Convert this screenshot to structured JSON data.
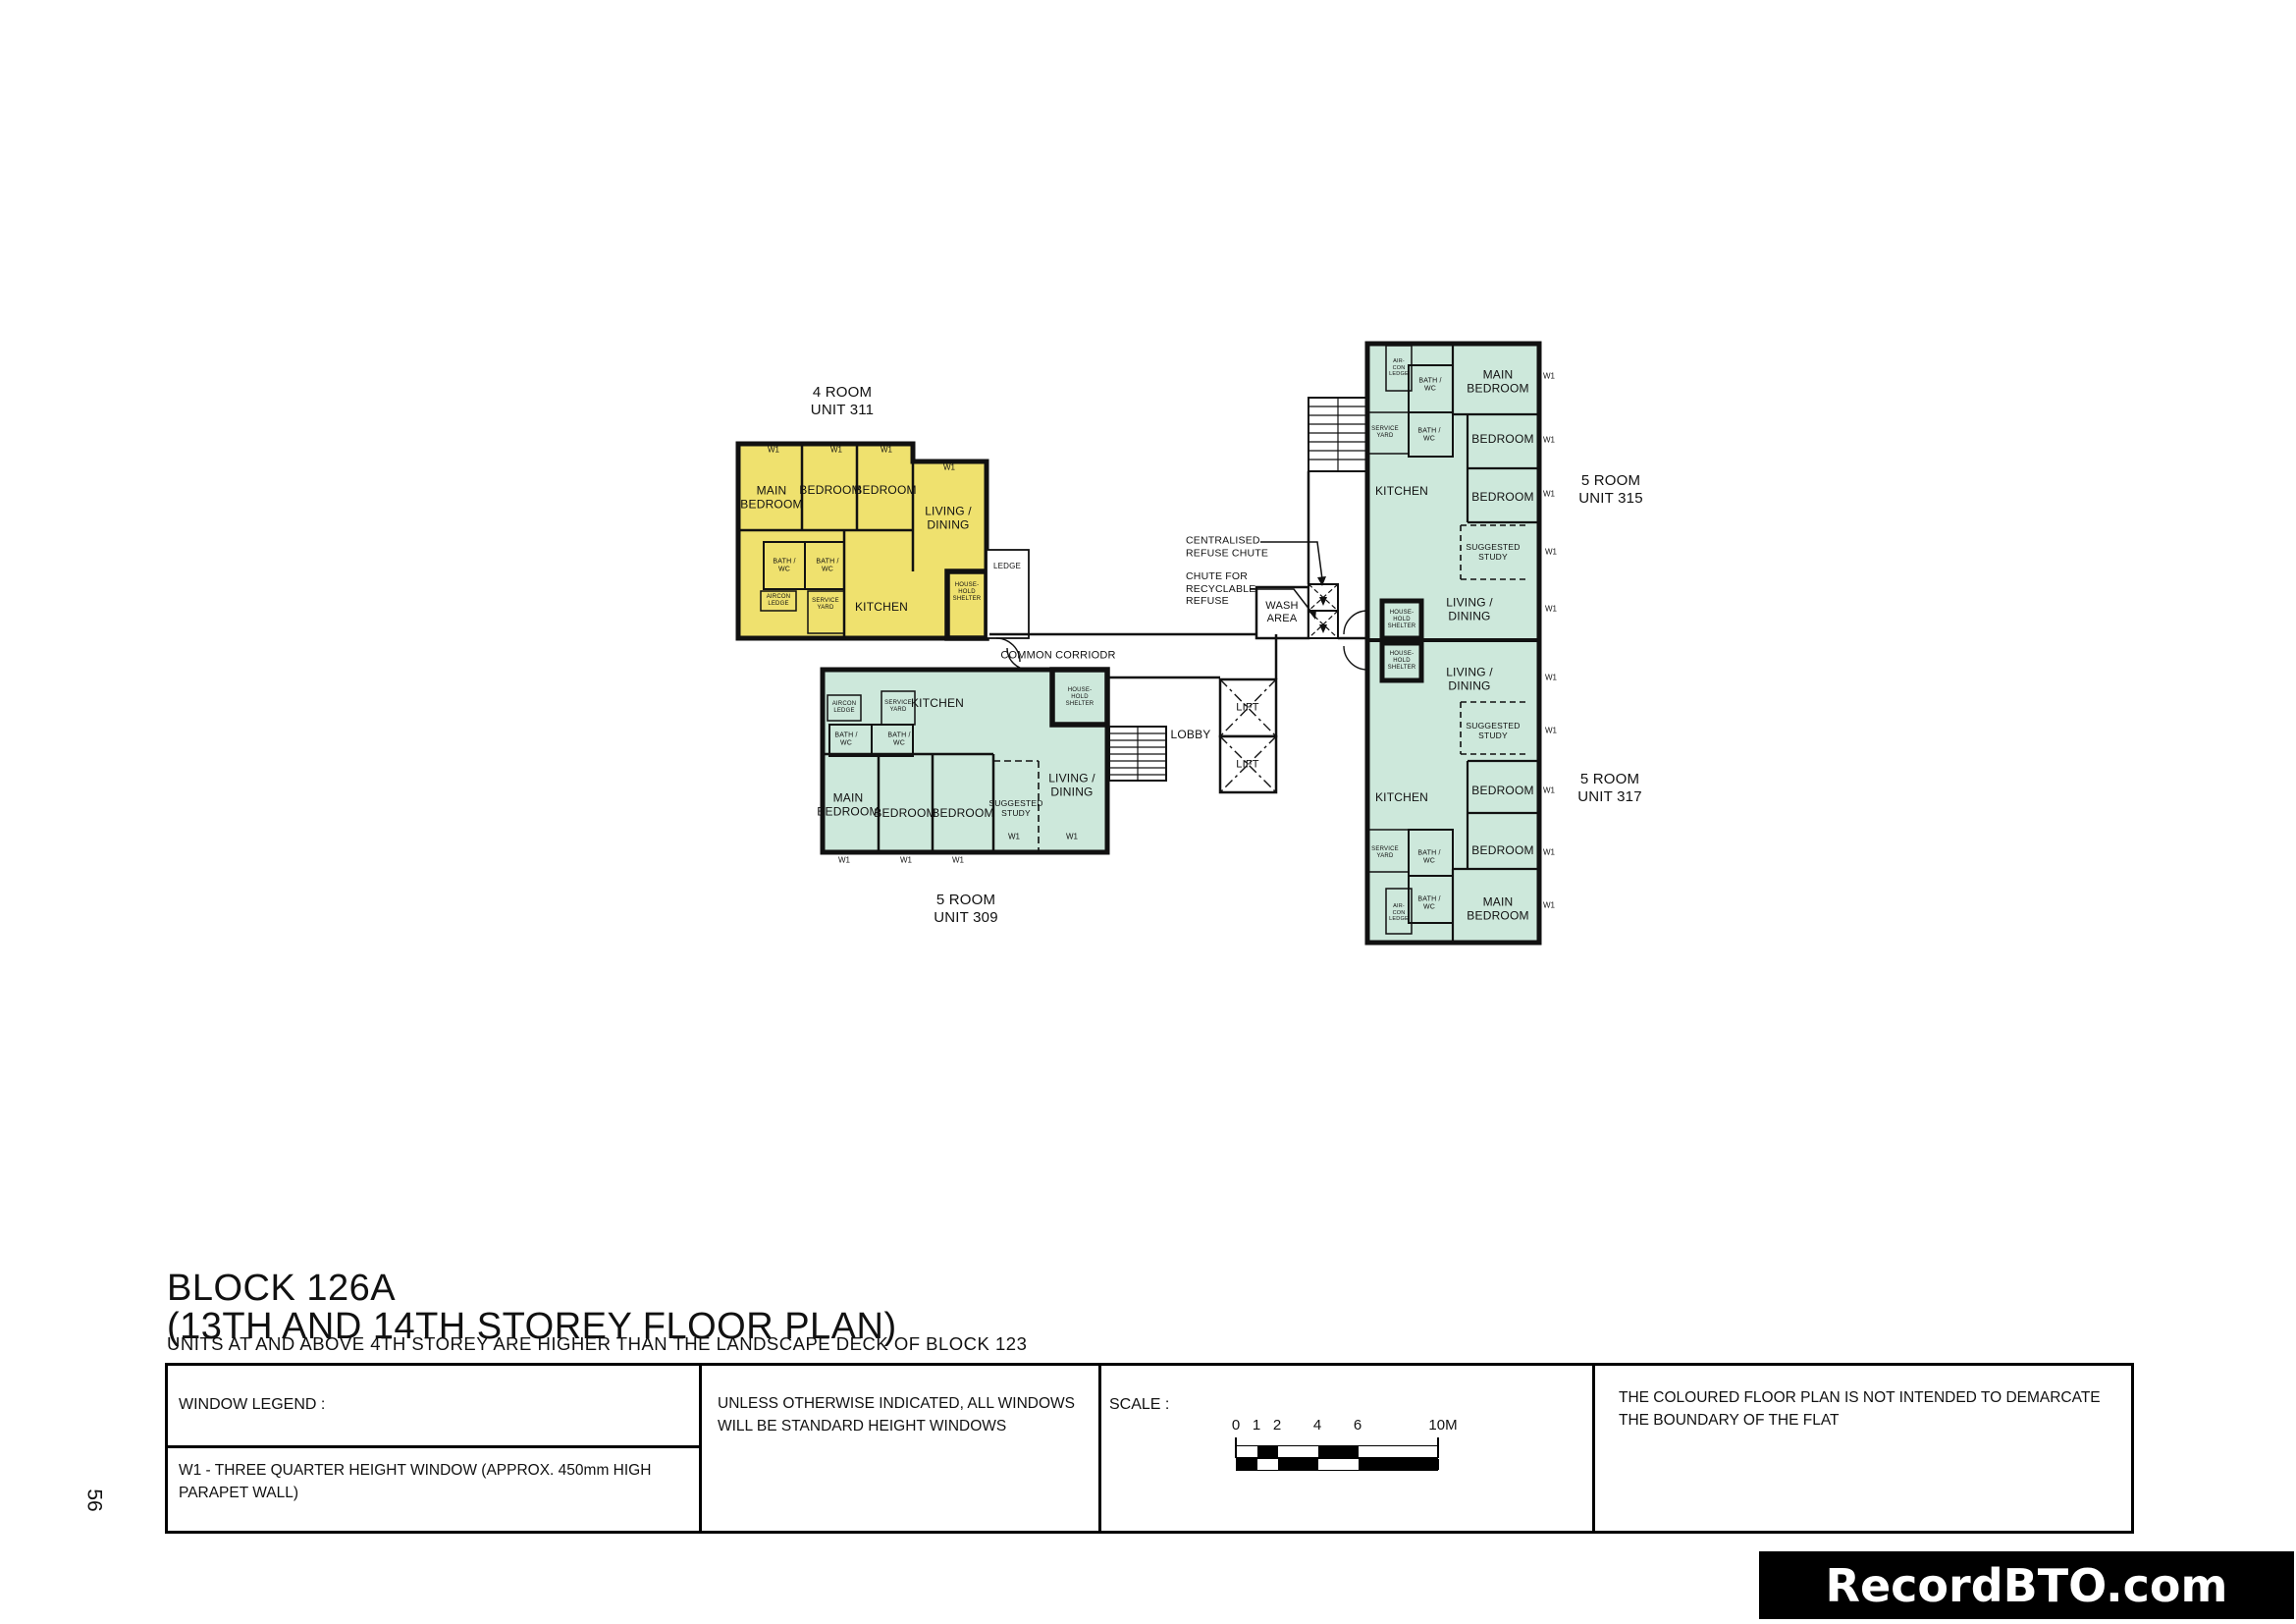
{
  "page_number": "56",
  "watermark": "RecordBTO.com",
  "title": {
    "line1": "BLOCK 126A",
    "line2": "(13TH AND 14TH STOREY FLOOR PLAN)",
    "note": "UNITS AT AND ABOVE 4TH STOREY ARE HIGHER THAN THE LANDSCAPE DECK OF BLOCK 123"
  },
  "legend": {
    "window_legend_header": "WINDOW LEGEND :",
    "window_legend_body": "W1 - THREE QUARTER HEIGHT WINDOW (APPROX. 450mm HIGH PARAPET WALL)",
    "windows_note": "UNLESS OTHERWISE INDICATED, ALL WINDOWS WILL BE STANDARD HEIGHT WINDOWS",
    "scale_header": "SCALE :",
    "scale_ticks": [
      "0",
      "1",
      "2",
      "4",
      "6",
      "10M"
    ],
    "boundary_note": "THE COLOURED FLOOR PLAN IS NOT INTENDED TO DEMARCATE THE BOUNDARY OF THE FLAT"
  },
  "colors": {
    "four_room_fill": "#EFE16E",
    "five_room_fill": "#CDE8DB",
    "wall": "#111111"
  },
  "labels": {
    "main_bedroom": "MAIN\nBEDROOM",
    "bedroom": "BEDROOM",
    "living_dining": "LIVING /\nDINING",
    "kitchen": "KITCHEN",
    "bath_wc": "BATH /\nWC",
    "aircon_ledge": "AIRCON\nLEDGE",
    "aircon_ledge_stacked": "AIR-\nCON\nLEDGE",
    "service_yard": "SERVICE\nYARD",
    "household_shelter": "HOUSE-\nHOLD\nSHELTER",
    "suggested_study": "SUGGESTED\nSTUDY",
    "ledge": "LEDGE",
    "wash_area": "WASH\nAREA",
    "lift": "LIFT",
    "lobby": "LOBBY",
    "common_corridor": "COMMON CORRIODR",
    "centralised_refuse_chute": "CENTRALISED\nREFUSE CHUTE",
    "recyclable_refuse_chute": "CHUTE FOR\nRECYCLABLE\nREFUSE",
    "window_mark": "W1"
  },
  "units": {
    "u311": {
      "type": "4 ROOM",
      "number": "311",
      "title": "4  ROOM\nUNIT 311"
    },
    "u309": {
      "type": "5 ROOM",
      "number": "309",
      "title": "5  ROOM\nUNIT 309"
    },
    "u315": {
      "type": "5 ROOM",
      "number": "315",
      "title": "5 ROOM\nUNIT 315"
    },
    "u317": {
      "type": "5 ROOM",
      "number": "317",
      "title": "5 ROOM\nUNIT 317"
    }
  }
}
